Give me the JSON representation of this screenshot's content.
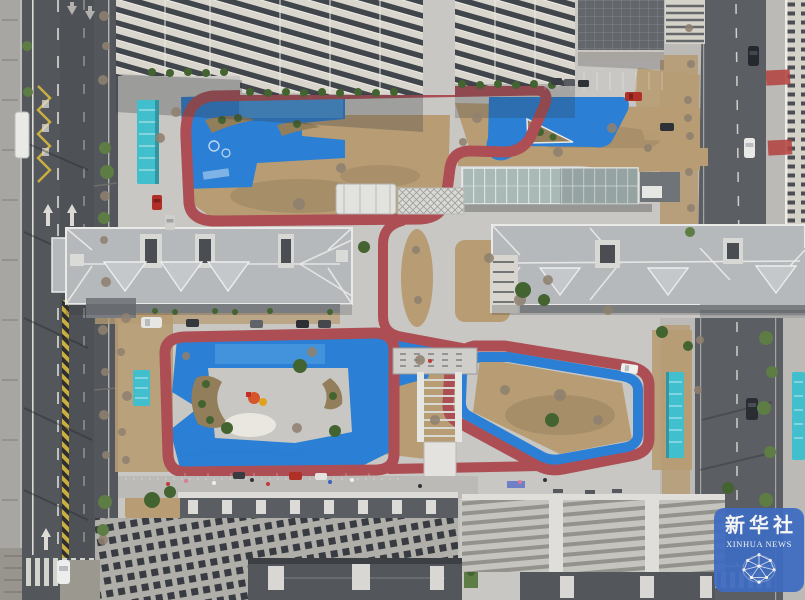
{
  "scene": {
    "alt": "Aerial drone view of a residential compound: blue playground surfaces and a red jogging track wind between apartment buildings, with city roads on both sides"
  },
  "watermark": {
    "title_cn": "新华社",
    "title_en": "XINHUA NEWS"
  },
  "colors": {
    "concrete": "#c8c7c3",
    "sidewalk": "#bbbab6",
    "asphalt": "#53575b",
    "asphalt2": "#5b5f63",
    "dirt": "#b79c74",
    "dirt_dark": "#937e5c",
    "green": "#5d7d45",
    "green_dark": "#436430",
    "blue": "#2b7fd4",
    "blue_light": "#5aa7e4",
    "red": "#ad4e55",
    "roof": "#b6b9bc",
    "ridge": "#e9eae8",
    "facade": "#d9d6cd",
    "window": "#41454c",
    "teal": "#41bfcc",
    "glass": "#a9bab6",
    "sand": "#eae7e0",
    "lane_white": "#eceae4",
    "lane_yellow": "#d9b93e",
    "wm_blue": "#3e6bc1"
  }
}
